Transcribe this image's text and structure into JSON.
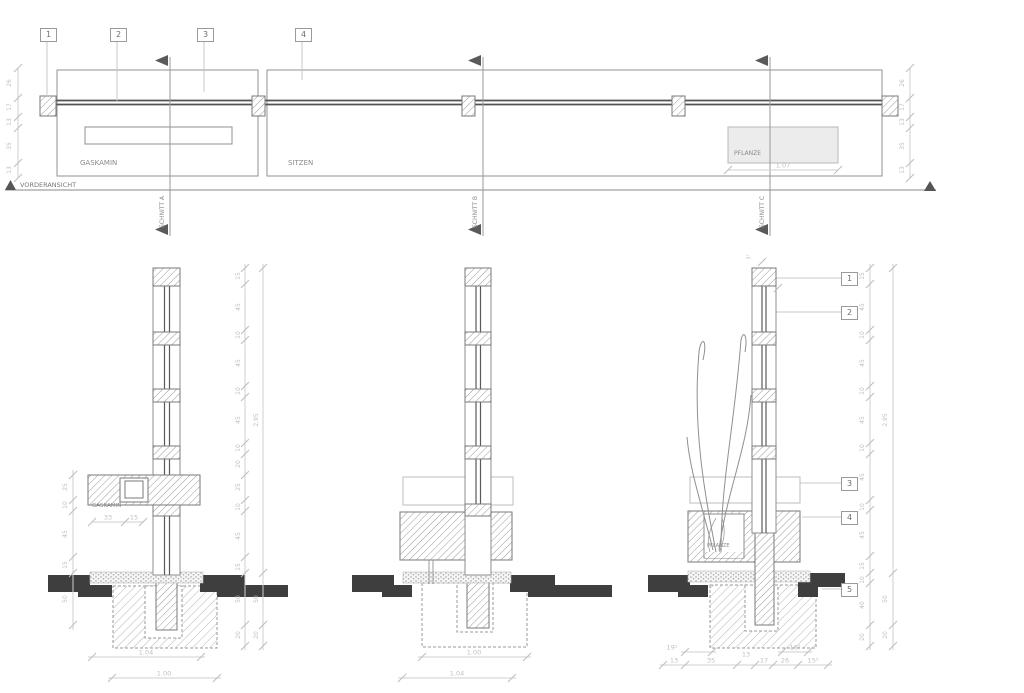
{
  "colors": {
    "line": "#8c8c8c",
    "dark_fill": "#3e3e3e",
    "dim": "#bfbfbf",
    "panel_fill": "#ececec"
  },
  "elevation": {
    "view_label": "VORDERANSICHT",
    "markers": [
      "1",
      "2",
      "3",
      "4"
    ],
    "gaskamin": "GASKAMIN",
    "sitzen": "SITZEN",
    "pflanze": "PFLANZE",
    "pflanze_width": "1.07",
    "left_chain": [
      "26",
      "17",
      "13",
      "35",
      "13"
    ],
    "right_chain": [
      "26",
      "17",
      "13",
      "35",
      "13"
    ],
    "cuts": [
      "SCHNITT A",
      "SCHNITT B",
      "SCHNITT C"
    ]
  },
  "section_a": {
    "gaskamin": "GASKAMIN",
    "dim_33": "33",
    "dim_15": "15",
    "width_top": "1.04",
    "width_bottom": "1.00",
    "left_chain": [
      "25",
      "10",
      "45",
      "15",
      "50"
    ],
    "right_chain": [
      "15",
      "45",
      "10",
      "45",
      "10",
      "45",
      "10",
      "20",
      "25",
      "10",
      "45",
      "15",
      "50",
      "20"
    ],
    "outer_chain": [
      "2.95",
      "50",
      "20"
    ]
  },
  "section_b": {
    "width_top": "1.00",
    "width_bottom": "1.04"
  },
  "section_c": {
    "pflanze": "PFLANZE",
    "top_dim": "3⁵",
    "markers": [
      "1",
      "2",
      "3",
      "4",
      "5"
    ],
    "right_chain": [
      "15",
      "45",
      "10",
      "45",
      "10",
      "45",
      "10",
      "45",
      "10",
      "45",
      "15",
      "10",
      "40",
      "20"
    ],
    "outer_chain": [
      "2.95",
      "50",
      "20"
    ],
    "bottom_upper": [
      "19⁵",
      "16⁵"
    ],
    "bottom_lower": [
      "13",
      "35",
      "13",
      "17",
      "26",
      "15⁵"
    ]
  }
}
